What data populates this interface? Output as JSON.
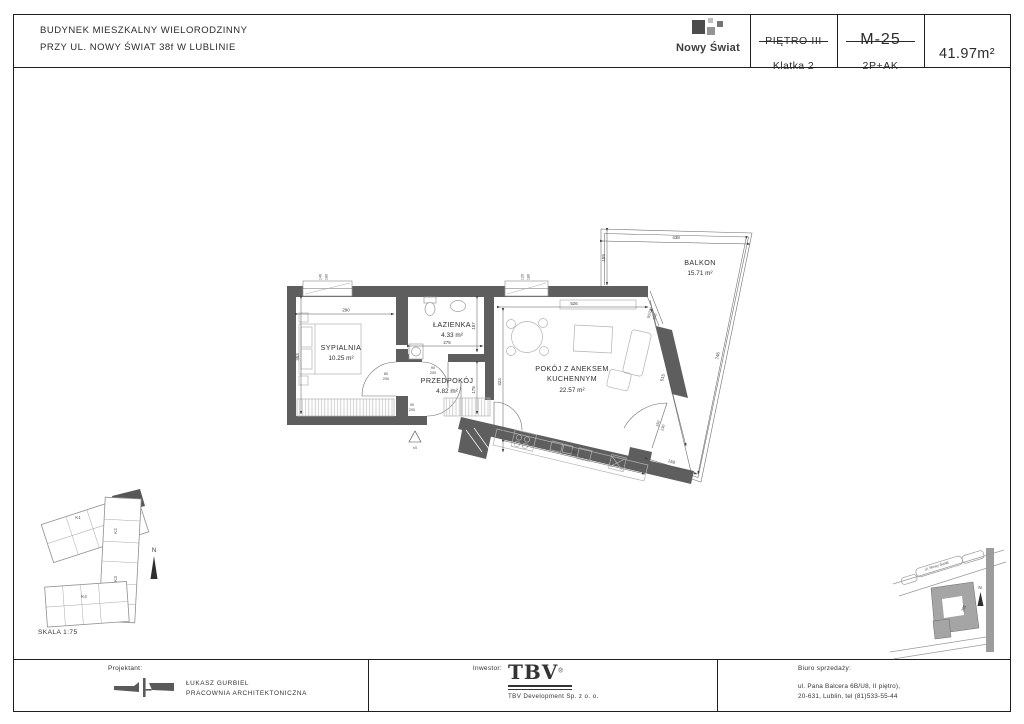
{
  "header": {
    "title_line1": "BUDYNEK MIESZKALNY WIELORODZINNY",
    "title_line2": "PRZY UL. NOWY ŚWIAT 38f W LUBLINIE",
    "logo_text": "Nowy Świat",
    "floor_label": "PIĘTRO III",
    "staircase_label": "Klatka 2",
    "unit_code": "M-25",
    "unit_type": "2P+AK",
    "area_total": "41.97m²"
  },
  "plan": {
    "rooms": {
      "bedroom": {
        "name": "SYPIALNIA",
        "area": "10.25 m²"
      },
      "bathroom": {
        "name": "ŁAZIENKA",
        "area": "4.33 m²"
      },
      "hall": {
        "name": "PRZEDPOKÓJ",
        "area": "4.82 m²"
      },
      "living": {
        "name_line1": "POKÓJ Z ANEKSEM",
        "name_line2": "KUCHENNYM",
        "area": "22.57 m²"
      },
      "balcony": {
        "name": "BALKON",
        "area": "15.71 m²"
      }
    },
    "dims": {
      "bedroom_w": "290",
      "bedroom_h": "353",
      "bathroom_w": "275",
      "bathroom_h": "157",
      "hall_h": "175",
      "living_w": "526",
      "living_h": "423",
      "living_right": "515",
      "kitchen_w": "434",
      "balcony_w": "438",
      "balcony_left": "159",
      "balcony_right": "746",
      "balcony_bottom": "159",
      "door_bedroom_w": "80",
      "door_bedroom_h": "200",
      "door_bath_w": "90",
      "door_bath_h": "200",
      "door_entry_w": "90",
      "door_entry_h": "200",
      "window1_w": "140",
      "window1_h": "180",
      "window2_w": "120",
      "window2_h": "180",
      "balcony_corner_win": "90/230",
      "balcony_corner_sill": "190",
      "balcony_door_w": "150",
      "balcony_door_h": "230",
      "level_marker": "±0"
    }
  },
  "site_plan": {
    "k1": "K1",
    "k2": "K2",
    "k3": "K3",
    "k4": "K4",
    "north": "N",
    "scale": "SKALA 1:75"
  },
  "location_map": {
    "street": "ul. Nowy Świat",
    "building": "38f",
    "north": "N"
  },
  "footer": {
    "designer_label": "Projektant:",
    "designer_name": "ŁUKASZ GURBIEL",
    "designer_firm": "PRACOWNIA ARCHITEKTONICZNA",
    "investor_label": "Inwestor:",
    "investor_logo": "TBV",
    "investor_reg": "®",
    "investor_name": "TBV  Development Sp. z o. o.",
    "sales_label": "Biuro sprzedaży:",
    "sales_addr1": "ul. Pana Balcera 6B/U8, II piętro),",
    "sales_addr2": "20-631, Lublin, tel (81)533-55-44"
  }
}
